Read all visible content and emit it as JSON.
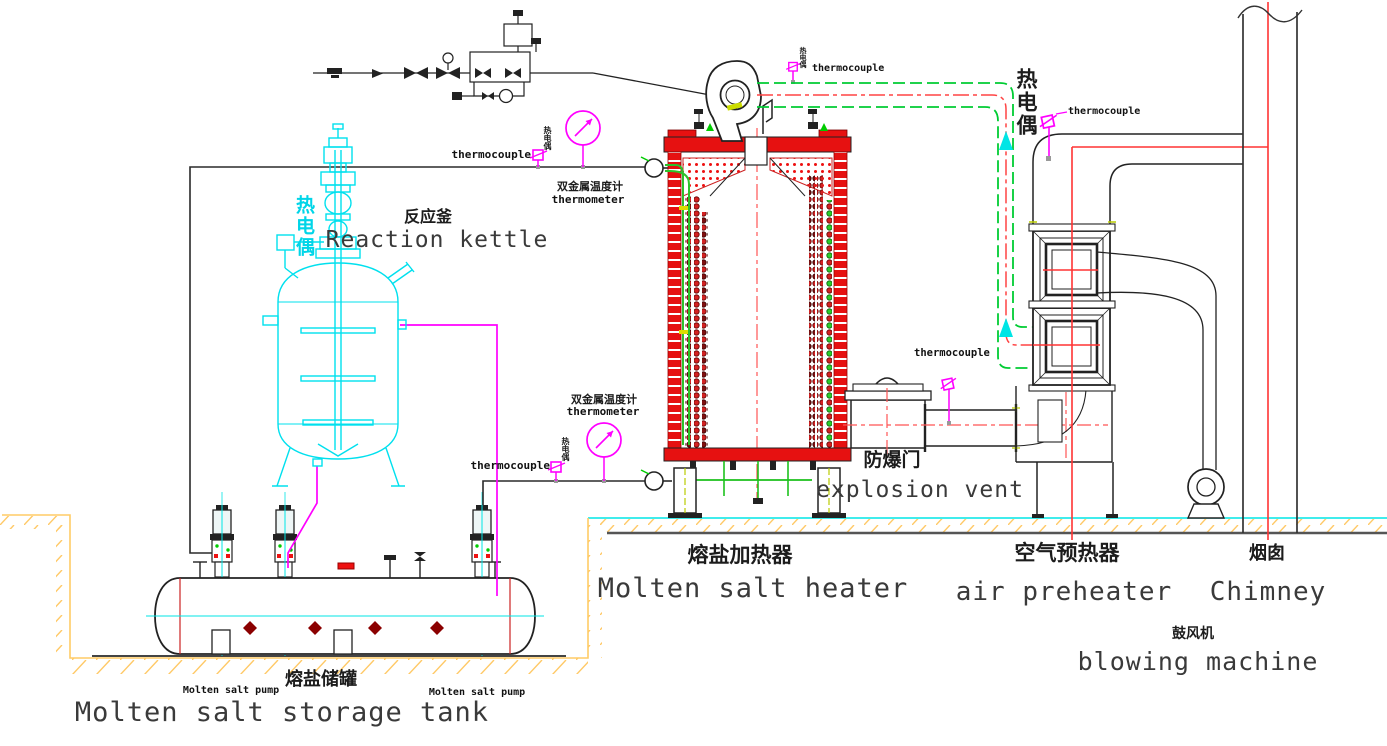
{
  "equipment": {
    "reaction_kettle": {
      "zh": "反应釜",
      "en": "Reaction kettle"
    },
    "molten_salt_heater": {
      "zh": "熔盐加热器",
      "en": "Molten salt heater"
    },
    "explosion_vent": {
      "zh": "防爆门",
      "en": "explosion vent"
    },
    "air_preheater": {
      "zh": "空气预热器",
      "en": "air preheater"
    },
    "chimney": {
      "zh": "烟囱",
      "en": "Chimney"
    },
    "blowing_machine": {
      "zh": "鼓风机",
      "en": "blowing machine"
    },
    "molten_salt_storage_tank": {
      "zh": "熔盐储罐",
      "en": "Molten salt storage tank"
    },
    "molten_salt_pump": {
      "en": "Molten salt pump"
    }
  },
  "instruments": {
    "thermocouple": {
      "en": "thermocouple",
      "zh": "热电偶"
    },
    "thermometer": {
      "en": "thermometer",
      "zh": "双金属温度计"
    }
  },
  "colors": {
    "equipment_red": "#ee1111",
    "pipe_green": "#22cc33",
    "instrument_magenta": "#ff00ff",
    "centerline_cyan": "#00e5e5",
    "ground_yellow": "#ffcc66",
    "flue_red": "#ff3333",
    "kettle_cyan": "#00e0ee",
    "diamond_darkred": "#8b0000",
    "line_black": "#222222"
  }
}
